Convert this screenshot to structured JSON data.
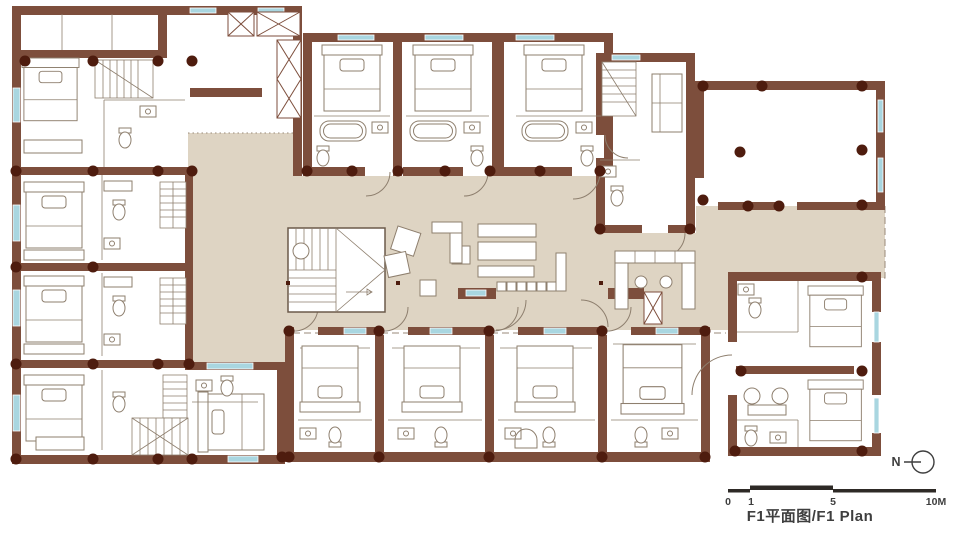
{
  "plan": {
    "title": "F1平面图/F1 Plan",
    "north_label": "N",
    "scale_bar": {
      "labels": [
        "0",
        "1",
        "5",
        "10M"
      ]
    },
    "colors": {
      "wall": "#7d4e3c",
      "column": "#4e1c0e",
      "floor": "#ded4c3",
      "window": "#a9d6e0",
      "furniture": "#8e7f6e",
      "dash": "#9a8a78",
      "ink": "#3e3e3e",
      "paper": "#ffffff"
    }
  }
}
